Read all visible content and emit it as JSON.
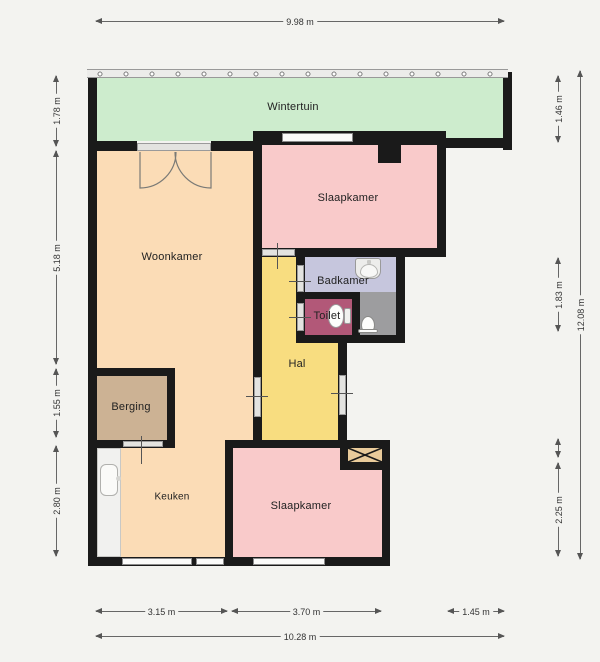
{
  "rooms": [
    {
      "name": "wintertuin",
      "label": "Wintertuin"
    },
    {
      "name": "slaapkamer-1",
      "label": "Slaapkamer"
    },
    {
      "name": "woonkamer",
      "label": "Woonkamer"
    },
    {
      "name": "badkamer",
      "label": "Badkamer"
    },
    {
      "name": "toilet",
      "label": "Toilet"
    },
    {
      "name": "hal",
      "label": "Hal"
    },
    {
      "name": "berging",
      "label": "Berging"
    },
    {
      "name": "keuken",
      "label": "Keuken"
    },
    {
      "name": "slaapkamer-2",
      "label": "Slaapkamer"
    }
  ],
  "dimensions": {
    "top_width": "9.98 m",
    "left": [
      "1.78 m",
      "5.18 m",
      "1.55 m",
      "2.80 m"
    ],
    "right": [
      "1.46 m",
      "1.83 m",
      "2.25 m"
    ],
    "right_total": "12.08 m",
    "bottom": [
      "3.15 m",
      "3.70 m",
      "1.45 m"
    ],
    "bottom_total": "10.28 m"
  },
  "colors": {
    "background": "#f3f3f0",
    "wall": "#1a1a1a",
    "wintertuin": "#cdeccd",
    "woonkamer": "#fbdcb6",
    "keuken": "#fbdcb6",
    "slaapkamer": "#f9caca",
    "badkamer": "#c6c6dd",
    "toilet": "#b25878",
    "hal": "#f8dd80",
    "berging": "#ccb294",
    "shaft": "#e9cb9b",
    "shower_floor": "#9d9d9f"
  }
}
